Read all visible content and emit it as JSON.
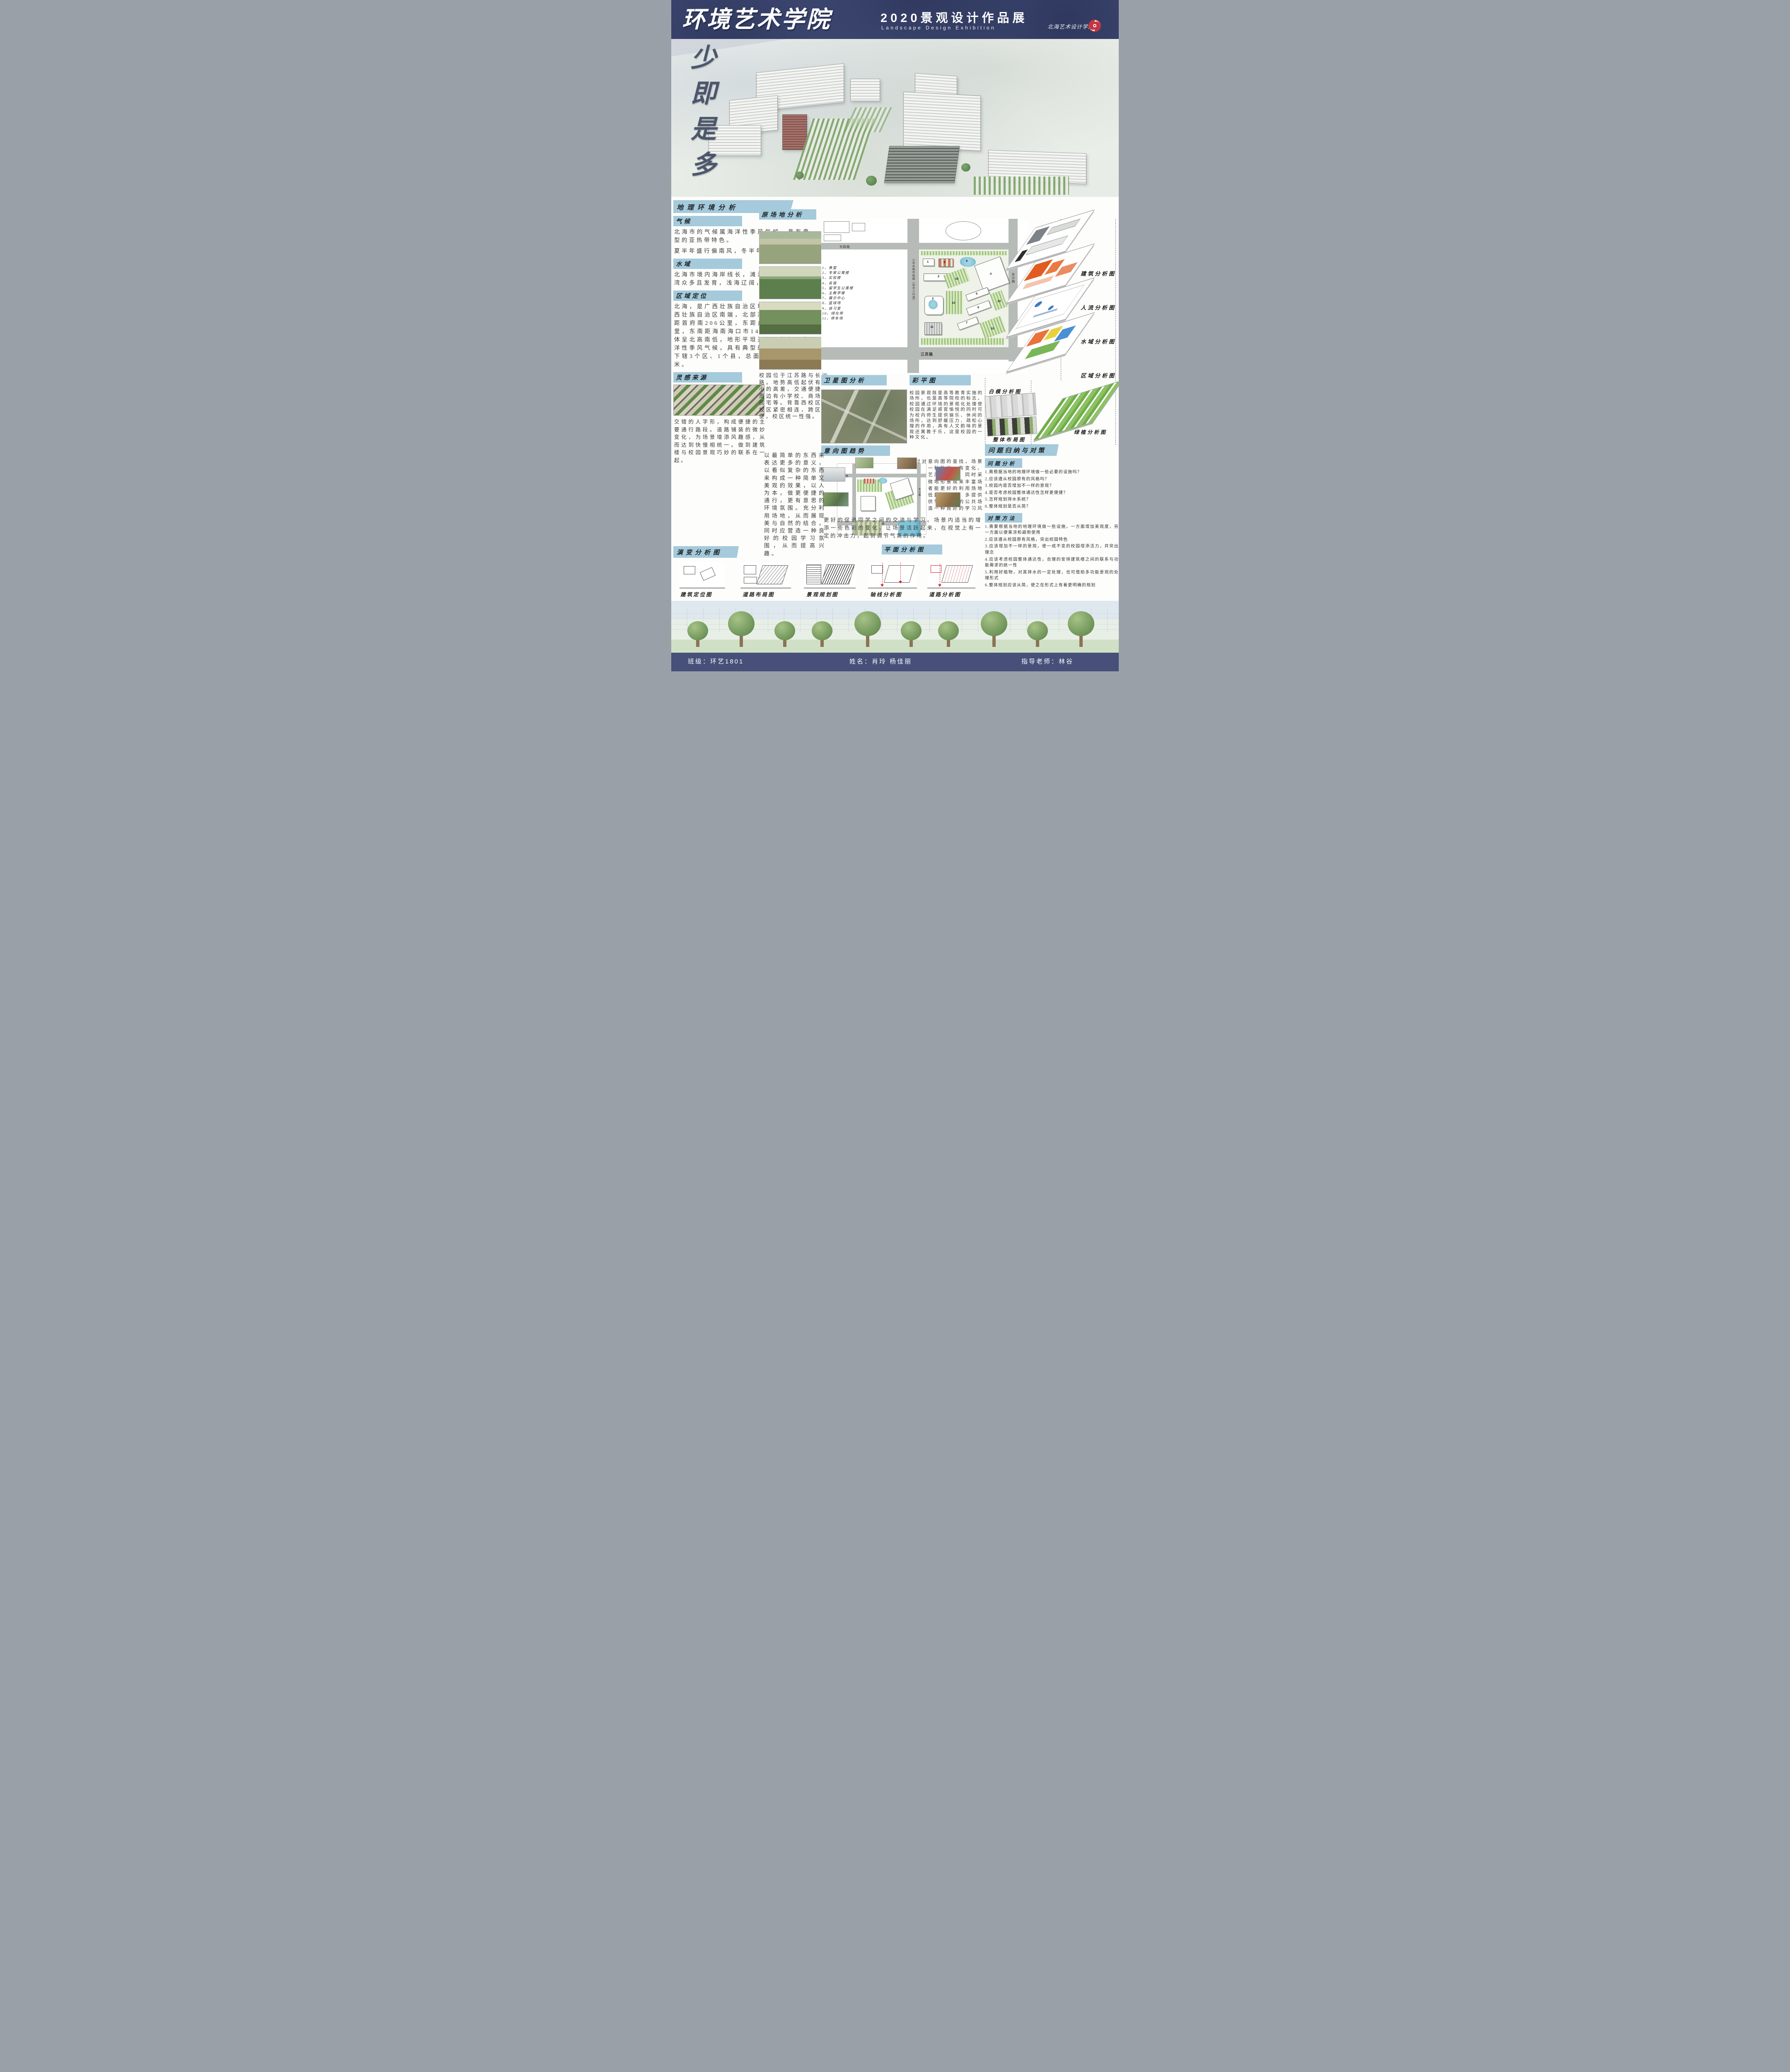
{
  "header": {
    "title": "环境艺术学院",
    "subtitle": "2020景观设计作品展",
    "subtitle_en": "Landscape Design Exhibition",
    "school": "北海艺术设计学院"
  },
  "hero": {
    "slogan": "少即是多"
  },
  "geo": {
    "title": "地理环境分析",
    "climate_label": "气候",
    "climate_p1": "北海市的气候属海洋性季风气候，具有典型的亚热带特色。",
    "climate_p2": "夏半年盛行偏南风，冬半年多吹偏北风。",
    "water_label": "水域",
    "water_text": "北海市境内海岸线长，滩涂宽广，沙滩港湾众多且发育，浅海辽阔，水道多。",
    "region_label": "区域定位",
    "region_text": "北海，是广西壮族自治区地级市，地处广西壮族自治区南端，北部湾东北岸。西北距首府南206公里，东距广东湛江198公里，东南距海南海口市147海里。地势总体呈北高南低，地形平坦开阔；气候属海洋性季风气候，具有典型的亚热带特色；下辖3个区、1个县，总面积3337平方千米。"
  },
  "site": {
    "title": "原场地分析",
    "caption": "校园位于江苏路与长沙路。地势高低起伏有较小的高差，交通便捷，周边有小学校、商场、民宅等。背靠西校区，校区紧密相连，跨区方便，校区统一性强。"
  },
  "plan": {
    "legend": [
      "1、食堂",
      "2、专家公寓楼",
      "3、实验楼",
      "4、名宿",
      "5、留学生公寓楼",
      "6、主教学楼",
      "7、展示中心",
      "8、篮球场",
      "9、自习室",
      "10、绿化带",
      "11、停车场"
    ],
    "map_numbers": [
      "1",
      "2",
      "3",
      "4",
      "5",
      "6",
      "7",
      "8",
      "9",
      "10",
      "11"
    ],
    "road_top": "市政路",
    "road_left": "小学东侧市政路（包含人行道）",
    "road_right": "长沙路",
    "road_bottom": "江苏路"
  },
  "satellite": {
    "title": "卫星图分析"
  },
  "color_plan": {
    "title": "彩平图",
    "text": "校园景观既是高等教育实施的场所，也是高等院校的标志。校园通过环境的景观化处理使校园在满足感官愉悦的同时可为校内师生提供娱乐、休闲的场所，达到舒缓压力、疏松心理的作用，具有人文韵味的景观还寓教于乐，这是校园的一种文化。",
    "lead": "通过对意向图的查找，场景主要以一种放松、有变化、清新文艺风采为主。同时采用一些微地形景观来丰富场地，再者能更好的利用场地内的高低起伏地形。多提供一些可供学生交流的公共场所。营造一种良好的学习风气。"
  },
  "layers": {
    "building": "建筑分析图",
    "flow": "人流分析图",
    "water": "水域分析图",
    "region": "区域分析图",
    "green": "绿植分析图",
    "white_model": "白模分析图",
    "overall": "整体布局图"
  },
  "inspiration": {
    "title": "灵感来源",
    "caption": "交错的人字形，构成便捷的主要通行路段。道路铺装的微妙变化，为场景增添风趣感，从而达到快慢相统一。做到建筑楼与校园景观巧妙的联系在一起。"
  },
  "concept": "以最简单的东西来表达更多的意义，以看似复杂的东西来构成一种简单又美观的效果，以人为本，做更便捷的通行，更有意思的环境氛围。充分利用场地，从而展现美与自然的结合，同时应营造一种良好的校园学习氛围，从而提高兴趣。",
  "intent": {
    "title": "意向图趋势",
    "caption": "更好的促进同学之间的交流与学习。场景内适当的增添一些色彩的变化，让场景活跃起来，在视觉上有一定的冲击力，起到调节气氛的作用。"
  },
  "problems": {
    "title": "问题归纳与对策",
    "analysis_label": "问题分析",
    "items": [
      "1.需根据当地的地理环境做一些必要的设施吗？",
      "2.应该遵从校园原有的风格吗？",
      "3.校园内是否增加不一样的景观？",
      "4.是否考虑校园整体通达性怎样更便捷？",
      "5.怎样规划排水系统？",
      "6.整体规划是否从简？"
    ],
    "strategy_label": "对策方法",
    "strategies": [
      "1.需要根据当地的地理环境做一些设施，一方面增加美观度，另一方面以便乘凉和避雨使用",
      "2.应该遵从校园原有风格，突出校园特色",
      "3.应该增加不一样的景观，使一成不变的校园增添活力，并突出理念",
      "4.应该考虑校园整体通达性，合理的安排建筑楼之间的联系与功能需求的统一性",
      "5.利用好植物，对其排水的一定处理，也可借助多功能景观的处理形式",
      "6.整体规划应该从简，使之在形式上有着更明确的规划"
    ]
  },
  "evolution": {
    "title": "演变分析图",
    "captions": [
      "建筑定位图",
      "道路布局图",
      "景观规划图"
    ]
  },
  "plan_analysis": {
    "title": "平面分析图",
    "captions": [
      "轴线分析图",
      "道路分析图"
    ]
  },
  "footer": {
    "class_label": "班级：环艺1801",
    "names": "姓名：肖玲 杨佳丽",
    "advisor": "指导老师：林谷"
  },
  "colors": {
    "header_blue": "#414c77",
    "heading_blue": "#a4cadb",
    "accent_red": "#c13540"
  }
}
